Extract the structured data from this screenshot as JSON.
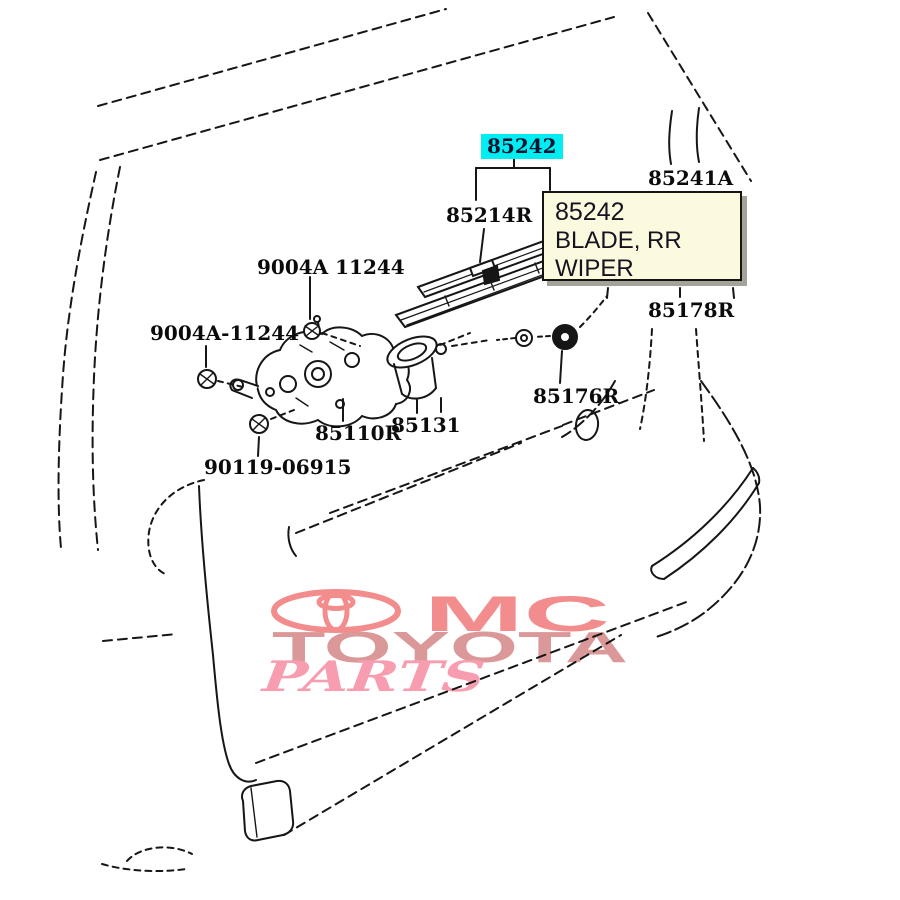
{
  "diagram": {
    "description_kind": "parts-line-art",
    "line_color": "#161616",
    "highlight_color": "#00eef2",
    "parts": [
      {
        "id": "85242",
        "label": "85242",
        "x": 481,
        "y": 134,
        "highlighted": true
      },
      {
        "id": "85214R",
        "label": "85214R",
        "x": 446,
        "y": 204,
        "highlighted": false
      },
      {
        "id": "85241A",
        "label": "85241A",
        "x": 648,
        "y": 167,
        "highlighted": false
      },
      {
        "id": "85178R",
        "label": "85178R",
        "x": 648,
        "y": 299,
        "highlighted": false
      },
      {
        "id": "85176R",
        "label": "85176R",
        "x": 533,
        "y": 385,
        "highlighted": false
      },
      {
        "id": "85131",
        "label": "85131",
        "x": 391,
        "y": 414,
        "highlighted": false
      },
      {
        "id": "85110R",
        "label": "85110R",
        "x": 315,
        "y": 422,
        "highlighted": false
      },
      {
        "id": "90119-06915",
        "label": "90119-06915",
        "x": 204,
        "y": 456,
        "highlighted": false
      },
      {
        "id": "9004A-11244-upper",
        "label": "9004A 11244",
        "x": 257,
        "y": 256,
        "highlighted": false
      },
      {
        "id": "9004A-11244-lower",
        "label": "9004A-11244",
        "x": 150,
        "y": 322,
        "highlighted": false
      }
    ]
  },
  "tooltip": {
    "code": "85242",
    "name": "BLADE, RR WIPER",
    "background": "#fcfade"
  },
  "watermark": {
    "line1": "MC",
    "line2": "TOYOTA",
    "line3": "PARTS",
    "logo": "toyota-emblem",
    "color_primary": "#f28484",
    "color_secondary": "#d89090",
    "color_script": "#f795a9"
  }
}
